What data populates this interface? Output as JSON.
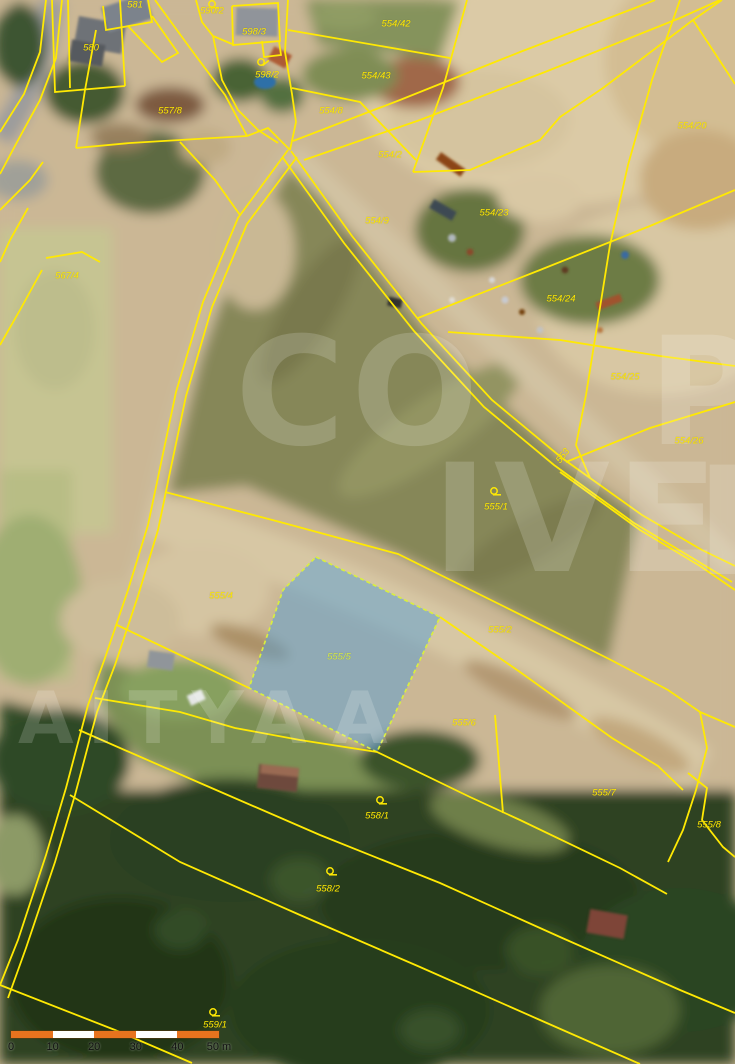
{
  "map": {
    "type": "cadastral-orthophoto-view",
    "boundary_color": "#ffe903",
    "label_color": "#ffe903",
    "highlighted_parcel": {
      "number": "555/5",
      "fill_color": "#5aa0d2",
      "border_color": "#d9ef3e"
    },
    "parcel_labels": [
      {
        "text": "581",
        "x": 135,
        "y": 5
      },
      {
        "text": "590/2",
        "x": 212,
        "y": 11
      },
      {
        "text": "598/3",
        "x": 254,
        "y": 32
      },
      {
        "text": "580",
        "x": 91,
        "y": 48
      },
      {
        "text": "598/2",
        "x": 267,
        "y": 75
      },
      {
        "text": "557/8",
        "x": 170,
        "y": 111
      },
      {
        "text": "554/42",
        "x": 396,
        "y": 24
      },
      {
        "text": "554/43",
        "x": 376,
        "y": 76
      },
      {
        "text": "554/8",
        "x": 331,
        "y": 111
      },
      {
        "text": "554/2",
        "x": 390,
        "y": 155
      },
      {
        "text": "554/20",
        "x": 692,
        "y": 126
      },
      {
        "text": "554/9",
        "x": 377,
        "y": 221
      },
      {
        "text": "554/23",
        "x": 494,
        "y": 213
      },
      {
        "text": "554/24",
        "x": 561,
        "y": 299
      },
      {
        "text": "554/25",
        "x": 625,
        "y": 377
      },
      {
        "text": "554/26",
        "x": 689,
        "y": 441
      },
      {
        "text": "553",
        "x": 563,
        "y": 456,
        "rot": -52
      },
      {
        "text": "567/4",
        "x": 67,
        "y": 276
      },
      {
        "text": "555/1",
        "x": 496,
        "y": 507
      },
      {
        "text": "555/4",
        "x": 221,
        "y": 596
      },
      {
        "text": "555/5",
        "x": 339,
        "y": 657,
        "color": "#d4e94c"
      },
      {
        "text": "555/2",
        "x": 500,
        "y": 630
      },
      {
        "text": "555/6",
        "x": 464,
        "y": 723
      },
      {
        "text": "555/7",
        "x": 604,
        "y": 793
      },
      {
        "text": "555/8",
        "x": 709,
        "y": 825
      },
      {
        "text": "558/1",
        "x": 377,
        "y": 816
      },
      {
        "text": "558/2",
        "x": 328,
        "y": 889
      },
      {
        "text": "559/1",
        "x": 215,
        "y": 1025
      }
    ],
    "symbols": [
      {
        "name": "land-use-symbol",
        "x": 212,
        "y": 4,
        "rot": 0
      },
      {
        "name": "land-use-symbol",
        "x": 261,
        "y": 62,
        "rot": -40
      },
      {
        "name": "land-use-symbol",
        "x": 494,
        "y": 491,
        "rot": 0
      },
      {
        "name": "land-use-symbol",
        "x": 380,
        "y": 800,
        "rot": 0
      },
      {
        "name": "land-use-symbol",
        "x": 330,
        "y": 871,
        "rot": 0
      },
      {
        "name": "land-use-symbol",
        "x": 213,
        "y": 1012,
        "rot": 0
      }
    ]
  },
  "watermark": {
    "color": "#ffffff",
    "opacity": 0.17,
    "fragments": [
      {
        "text": "CO",
        "x": 235,
        "y": 318,
        "size": 150,
        "spacing": 6
      },
      {
        "text": "P",
        "x": 648,
        "y": 318,
        "size": 150,
        "spacing": 0
      },
      {
        "text": "IVE",
        "x": 432,
        "y": 445,
        "size": 150,
        "spacing": 6
      },
      {
        "text": "E",
        "x": 696,
        "y": 448,
        "size": 150,
        "spacing": 0
      },
      {
        "text": "AITYA",
        "x": 18,
        "y": 682,
        "size": 72,
        "spacing": 14
      },
      {
        "text": "A",
        "x": 332,
        "y": 682,
        "size": 72,
        "spacing": 0
      }
    ]
  },
  "scalebar": {
    "x": 11,
    "y": 1031,
    "segment_width": 41.6,
    "segments": [
      "#e8731e",
      "#ffffff",
      "#e8731e",
      "#ffffff",
      "#e8731e"
    ],
    "ticks": [
      "0",
      "10",
      "20",
      "30",
      "40",
      "50 m"
    ]
  }
}
